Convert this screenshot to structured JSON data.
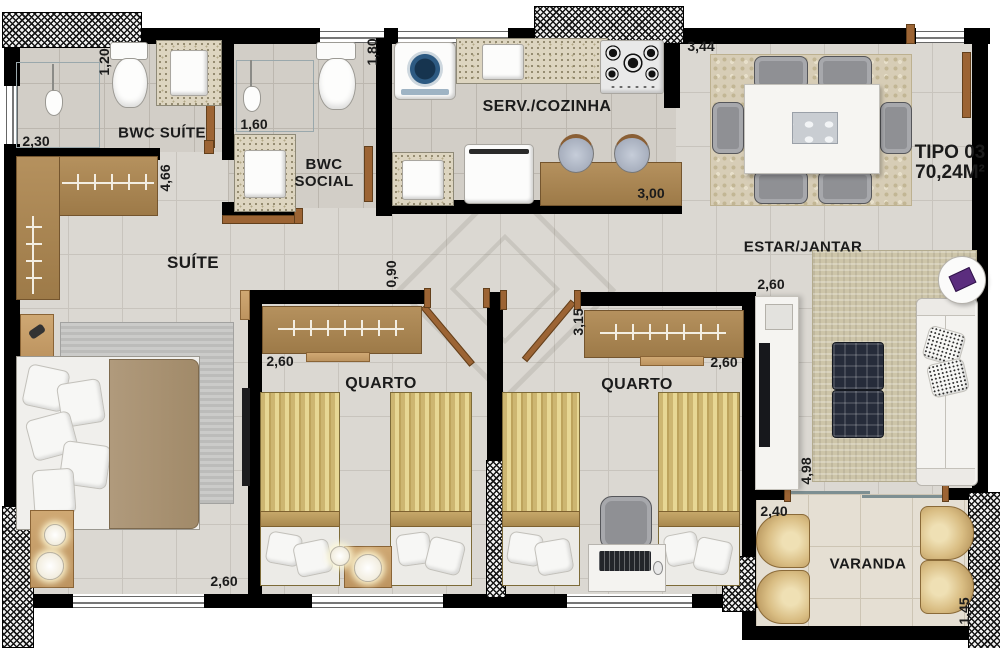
{
  "plan": {
    "type_label": "TIPO 03",
    "area_label": "70,24M²"
  },
  "rooms": {
    "bwc_suite": "BWC SUÍTE",
    "bwc_social": "BWC SOCIAL",
    "kitchen": "SERV./COZINHA",
    "dining": "ESTAR/JANTAR",
    "suite": "SUÍTE",
    "bedroom1": "QUARTO",
    "bedroom2": "QUARTO",
    "balcony": "VARANDA"
  },
  "dimensions": {
    "bwc_suite_depth": "1,20",
    "bwc_suite_width": "2,30",
    "bwc_social_width": "1,60",
    "bwc_social_depth": "1,80",
    "kitchen_width": "3,00",
    "dining_width": "3,44",
    "suite_depth": "4,66",
    "suite_width": "2,60",
    "hall_width": "0,90",
    "bedroom1_width": "2,60",
    "bedroom2_depth": "3,15",
    "bedroom2_width": "2,60",
    "living_width": "2,60",
    "living_depth": "4,98",
    "balcony_width": "2,40",
    "balcony_depth": "1,45"
  },
  "colors": {
    "wall": "#000000",
    "wood": "#a9834f",
    "floor_tile": "#dbd8d2",
    "bed_gold": "#d9c27c",
    "text": "#1b1b1b"
  }
}
